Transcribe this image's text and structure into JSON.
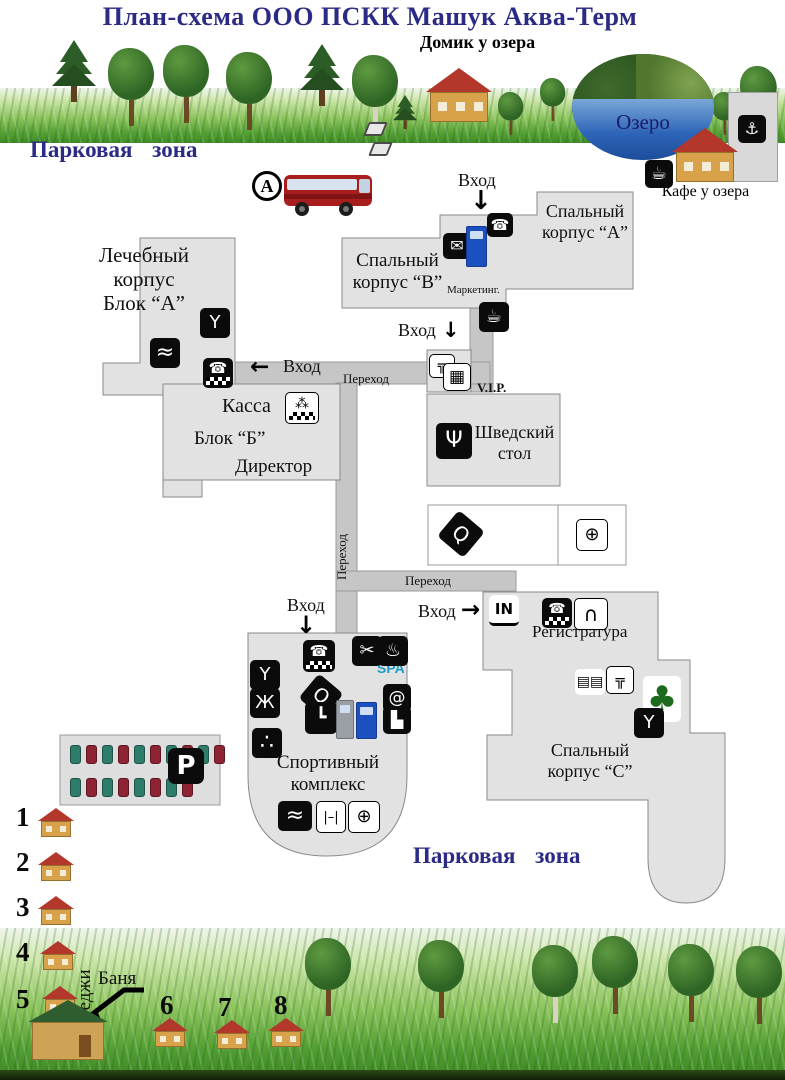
{
  "title": "План-схема ООО ПСКК Машук Аква-Терм",
  "zones": {
    "top": "Парковая  зона",
    "bottom": "Парковая  зона"
  },
  "lake": {
    "name": "Озеро",
    "house": "Домик у озера",
    "cafe": "Кафе у озера"
  },
  "bus_stop": {
    "letter": "А"
  },
  "labels": {
    "entrance": "Вход",
    "passage": "Переход",
    "vip": "V.I.P.",
    "marketing": "Маркетинг.",
    "kassa": "Касса",
    "block_b": "Блок “Б”",
    "director": "Директор",
    "registry": "Регистратура",
    "spa": "SPA",
    "banya": "Баня",
    "cottages": "Коттеджи",
    "parking": "P"
  },
  "buildings": {
    "medical": [
      "Лечебный",
      "корпус",
      "Блок “А”"
    ],
    "sleep_a": [
      "Спальный",
      "корпус “А”"
    ],
    "sleep_b": [
      "Спальный",
      "корпус “В”"
    ],
    "sleep_c": [
      "Спальный",
      "корпус “С”"
    ],
    "buffet": [
      "Шведский",
      "стол"
    ],
    "sport": [
      "Спортивный",
      "комплекс"
    ]
  },
  "cottage_numbers": [
    "1",
    "2",
    "3",
    "4",
    "5",
    "6",
    "7",
    "8"
  ],
  "icons": {
    "cocktail": "Y",
    "pool": "≈",
    "phone": "☎",
    "envelope": "✉",
    "coffee": "☕",
    "scissors": "✂",
    "sauna": "♨",
    "table_tennis": "Q",
    "gymnast": "Ж",
    "skate": "┗",
    "at": "@",
    "boot": "▙",
    "billiards": "∴",
    "dumbbell": "|–|",
    "basketball": "⊕",
    "cutlery": "Ψ",
    "cashier": "⁂",
    "turnstile": "IN",
    "arch": "∩",
    "market": "▤▤",
    "faucet": "╦",
    "gift": "▦",
    "tree": "♣",
    "boat": "⚓",
    "arrow_down": "↓",
    "arrow_left": "←",
    "arrow_right": "→"
  },
  "colors": {
    "navy": "#2b2b85",
    "building": "#e2e2e2",
    "path": "#c6c6c6",
    "spa_blue": "#1d9bc9"
  }
}
